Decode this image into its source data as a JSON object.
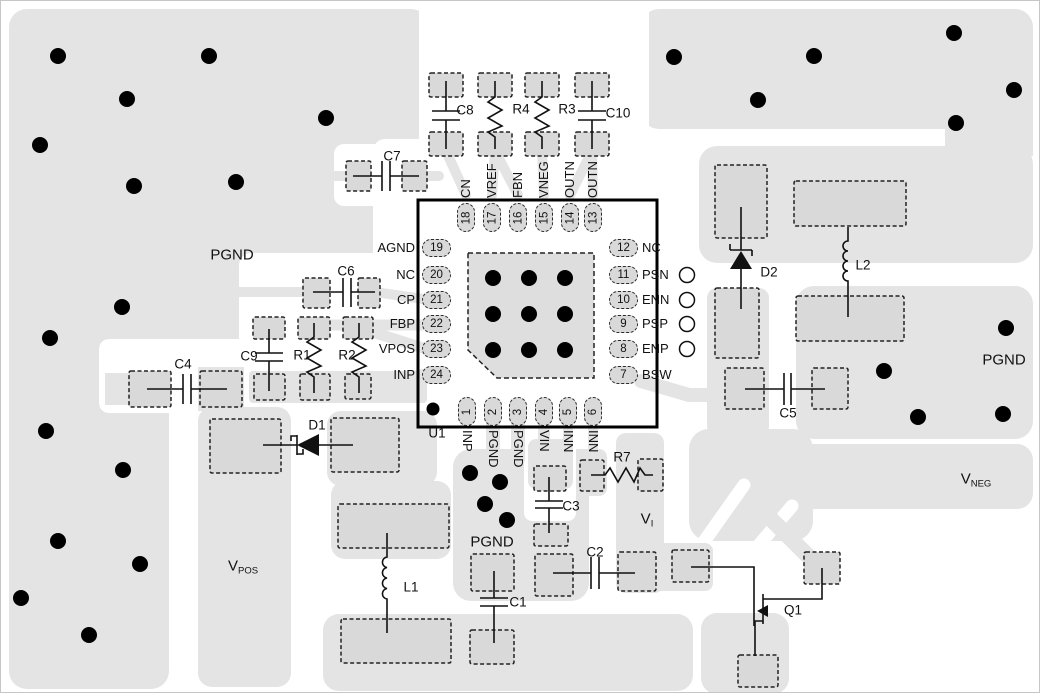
{
  "diagram": {
    "type": "pcb-layout-example",
    "colors": {
      "copper_pour": "#e4e4e4",
      "pad_fill": "#d9d9d9",
      "thermal_pad_fill": "#dedede",
      "via": "#000000",
      "outline": "#000000"
    }
  },
  "ic": {
    "ref": "U1",
    "pins": {
      "left": [
        {
          "num": "19",
          "name": "AGND"
        },
        {
          "num": "20",
          "name": "NC"
        },
        {
          "num": "21",
          "name": "CP"
        },
        {
          "num": "22",
          "name": "FBP"
        },
        {
          "num": "23",
          "name": "VPOS"
        },
        {
          "num": "24",
          "name": "INP"
        }
      ],
      "right": [
        {
          "num": "12",
          "name": "NC"
        },
        {
          "num": "11",
          "name": "PSN",
          "tp": true
        },
        {
          "num": "10",
          "name": "ENN",
          "tp": true
        },
        {
          "num": "9",
          "name": "PSP",
          "tp": true
        },
        {
          "num": "8",
          "name": "ENP",
          "tp": true
        },
        {
          "num": "7",
          "name": "BSW"
        }
      ],
      "top": [
        {
          "num": "18",
          "name": "CN"
        },
        {
          "num": "17",
          "name": "VREF"
        },
        {
          "num": "16",
          "name": "FBN"
        },
        {
          "num": "15",
          "name": "VNEG"
        },
        {
          "num": "14",
          "name": "OUTN"
        },
        {
          "num": "13",
          "name": "OUTN"
        }
      ],
      "bottom": [
        {
          "num": "1",
          "name": "INP"
        },
        {
          "num": "2",
          "name": "PGND"
        },
        {
          "num": "3",
          "name": "PGND"
        },
        {
          "num": "4",
          "name": "VIN"
        },
        {
          "num": "5",
          "name": "INN"
        },
        {
          "num": "6",
          "name": "INN"
        }
      ]
    }
  },
  "components": [
    {
      "ref": "C8",
      "x": 464,
      "y": 109
    },
    {
      "ref": "R4",
      "x": 520,
      "y": 108
    },
    {
      "ref": "R3",
      "x": 566,
      "y": 108
    },
    {
      "ref": "C10",
      "x": 617,
      "y": 112
    },
    {
      "ref": "C7",
      "x": 391,
      "y": 155
    },
    {
      "ref": "C6",
      "x": 345,
      "y": 270
    },
    {
      "ref": "C9",
      "x": 248,
      "y": 355
    },
    {
      "ref": "R1",
      "x": 301,
      "y": 354
    },
    {
      "ref": "R2",
      "x": 346,
      "y": 354
    },
    {
      "ref": "C4",
      "x": 182,
      "y": 363
    },
    {
      "ref": "D1",
      "x": 316,
      "y": 424
    },
    {
      "ref": "L1",
      "x": 410,
      "y": 586
    },
    {
      "ref": "C1",
      "x": 517,
      "y": 601
    },
    {
      "ref": "C2",
      "x": 594,
      "y": 551
    },
    {
      "ref": "C3",
      "x": 570,
      "y": 505
    },
    {
      "ref": "R7",
      "x": 621,
      "y": 456
    },
    {
      "ref": "C5",
      "x": 787,
      "y": 412
    },
    {
      "ref": "D2",
      "x": 768,
      "y": 271
    },
    {
      "ref": "L2",
      "x": 862,
      "y": 264
    },
    {
      "ref": "Q1",
      "x": 792,
      "y": 609
    },
    {
      "ref": "U1",
      "x": 436,
      "y": 432
    }
  ],
  "net_labels": [
    {
      "id": "pgnd-top-left",
      "base": "PGND",
      "sub": "",
      "x": 231,
      "y": 255
    },
    {
      "id": "pgnd-island",
      "base": "PGND",
      "sub": "",
      "x": 491,
      "y": 542
    },
    {
      "id": "pgnd-right",
      "base": "PGND",
      "sub": "",
      "x": 1003,
      "y": 360
    },
    {
      "id": "vpos",
      "base": "V",
      "sub": "POS",
      "x": 242,
      "y": 566
    },
    {
      "id": "vneg",
      "base": "V",
      "sub": "NEG",
      "x": 975,
      "y": 479
    },
    {
      "id": "vi",
      "base": "V",
      "sub": "I",
      "x": 646,
      "y": 519
    }
  ],
  "vias": [
    [
      57,
      55
    ],
    [
      208,
      55
    ],
    [
      126,
      98
    ],
    [
      325,
      117
    ],
    [
      39,
      144
    ],
    [
      133,
      185
    ],
    [
      235,
      181
    ],
    [
      121,
      306
    ],
    [
      673,
      56
    ],
    [
      813,
      55
    ],
    [
      757,
      99
    ],
    [
      953,
      32
    ],
    [
      1013,
      89
    ],
    [
      955,
      122
    ],
    [
      1005,
      327
    ],
    [
      883,
      370
    ],
    [
      917,
      416
    ],
    [
      1002,
      413
    ],
    [
      49,
      337
    ],
    [
      45,
      430
    ],
    [
      122,
      469
    ],
    [
      57,
      540
    ],
    [
      139,
      563
    ],
    [
      20,
      597
    ],
    [
      88,
      634
    ],
    [
      469,
      472
    ],
    [
      499,
      481
    ],
    [
      484,
      503
    ],
    [
      506,
      519
    ],
    [
      492,
      277
    ],
    [
      528,
      277
    ],
    [
      564,
      277
    ],
    [
      492,
      313
    ],
    [
      528,
      313
    ],
    [
      564,
      313
    ],
    [
      492,
      349
    ],
    [
      528,
      349
    ],
    [
      564,
      349
    ],
    [
      432,
      408,
      6.5
    ]
  ],
  "pads": [
    [
      428,
      72,
      34,
      24
    ],
    [
      477,
      72,
      34,
      24
    ],
    [
      524,
      72,
      34,
      24
    ],
    [
      574,
      72,
      34,
      24
    ],
    [
      428,
      131,
      34,
      24
    ],
    [
      477,
      131,
      34,
      24
    ],
    [
      524,
      131,
      34,
      24
    ],
    [
      574,
      131,
      34,
      24
    ],
    [
      345,
      160,
      25,
      30
    ],
    [
      401,
      160,
      25,
      30
    ],
    [
      302,
      277,
      27,
      30
    ],
    [
      357,
      277,
      22,
      30
    ],
    [
      252,
      316,
      32,
      22
    ],
    [
      297,
      316,
      32,
      22
    ],
    [
      342,
      316,
      30,
      22
    ],
    [
      253,
      373,
      31,
      26
    ],
    [
      299,
      373,
      30,
      26
    ],
    [
      344,
      373,
      26,
      25
    ],
    [
      128,
      370,
      42,
      36
    ],
    [
      199,
      370,
      42,
      36
    ],
    [
      209,
      418,
      71,
      54
    ],
    [
      330,
      417,
      68,
      54
    ],
    [
      337,
      503,
      111,
      44
    ],
    [
      340,
      618,
      110,
      44
    ],
    [
      470,
      553,
      43,
      37
    ],
    [
      469,
      629,
      44,
      34
    ],
    [
      534,
      553,
      38,
      42
    ],
    [
      617,
      551,
      38,
      39
    ],
    [
      533,
      465,
      32,
      25
    ],
    [
      533,
      523,
      34,
      22
    ],
    [
      579,
      459,
      24,
      31
    ],
    [
      637,
      458,
      25,
      32
    ],
    [
      724,
      367,
      39,
      41
    ],
    [
      811,
      367,
      36,
      41
    ],
    [
      714,
      164,
      52,
      73
    ],
    [
      714,
      287,
      44,
      70
    ],
    [
      793,
      180,
      112,
      45
    ],
    [
      795,
      295,
      108,
      45
    ],
    [
      671,
      549,
      37,
      32
    ],
    [
      803,
      551,
      36,
      32
    ],
    [
      737,
      654,
      40,
      32
    ]
  ]
}
